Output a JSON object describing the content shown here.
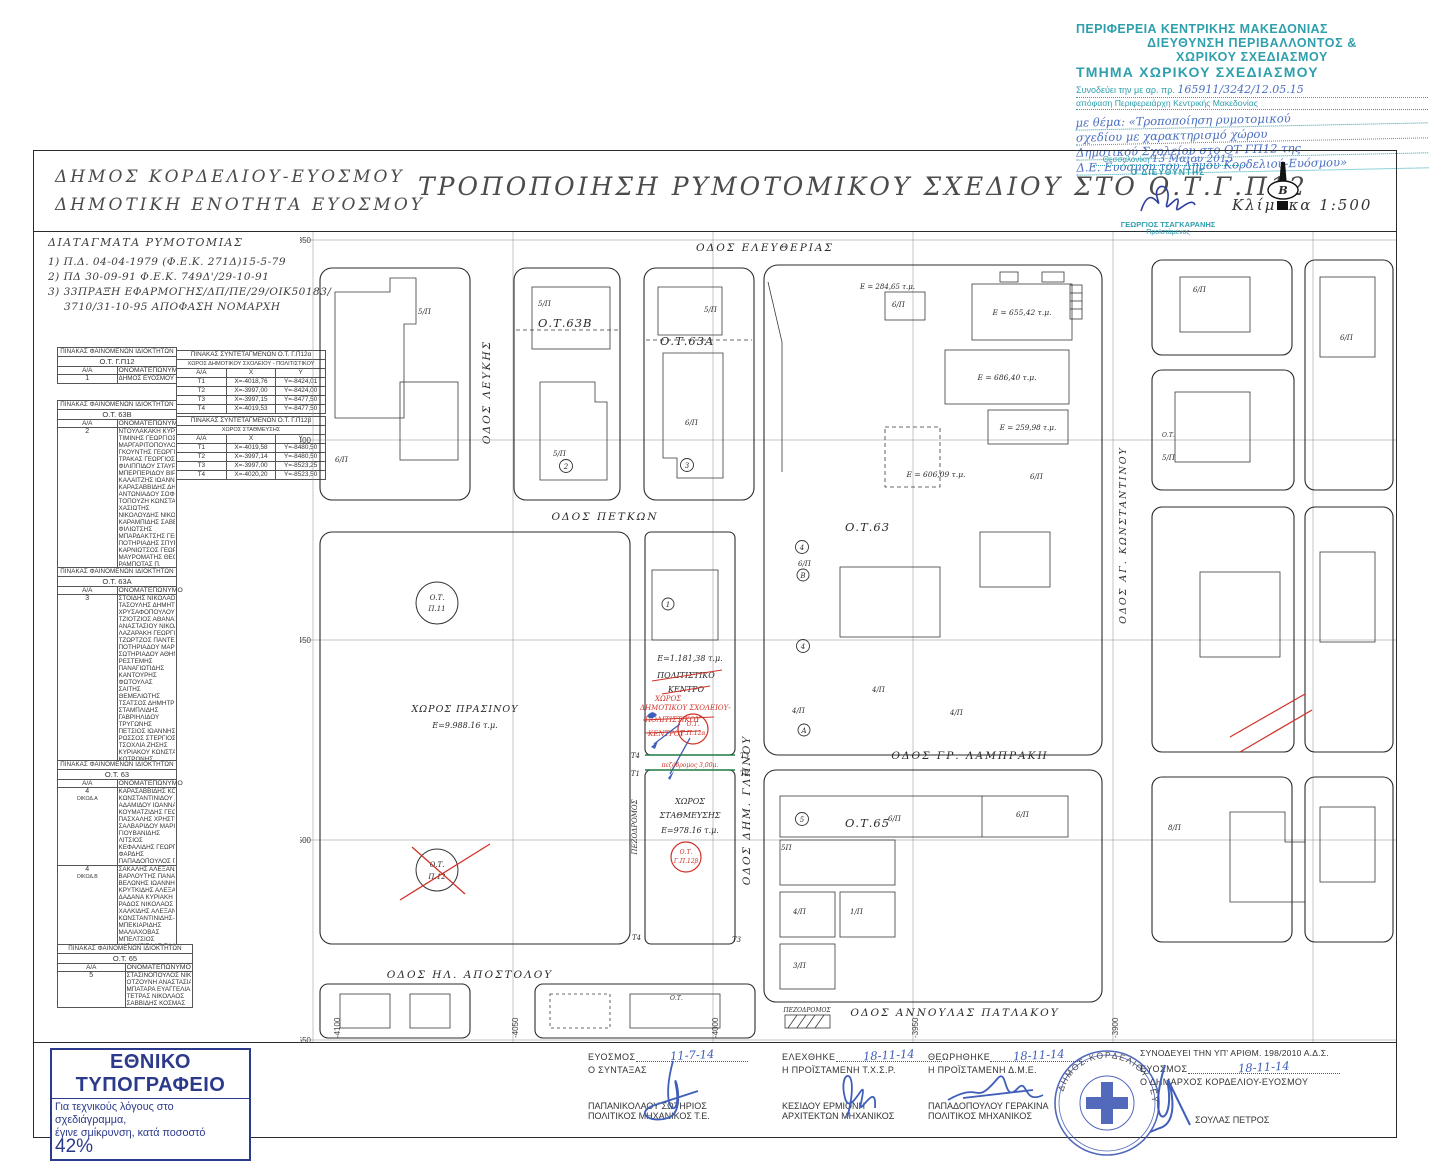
{
  "stamp_top": {
    "line1": "ΠΕΡΙΦΕΡΕΙΑ ΚΕΝΤΡΙΚΗΣ ΜΑΚΕΔΟΝΙΑΣ",
    "line2": "ΔΙΕΥΘΥΝΣΗ ΠΕΡΙΒΑΛΛΟΝΤΟΣ &",
    "line3": "ΧΩΡΙΚΟΥ ΣΧΕΔΙΑΣΜΟΥ",
    "line4": "ΤΜΗΜΑ ΧΩΡΙΚΟΥ ΣΧΕΔΙΑΣΜΟΥ",
    "ref_label": "Συνοδεύει την με αρ. πρ.",
    "ref_value": "165911/3242/12.05.15",
    "ref_line2": "απόφαση Περιφερειάρχη Κεντρικής Μακεδονίας",
    "handwritten": [
      "με θέμα: «Τροποποίηση ρυμοτομικού",
      "σχεδίου με χαρακτηρισμό χώρου",
      "Δημοτικού Σχολείου στο ΟΤ ΓΠ12 της",
      "Δ.Ε. Ευόσμου του Δήμου Κορδελιού-Ευόσμου»"
    ]
  },
  "title_block": {
    "muni1": "ΔΗΜΟΣ ΚΟΡΔΕΛΙΟΥ-ΕΥΟΣΜΟΥ",
    "muni2": "ΔΗΜΟΤΙΚΗ ΕΝΟΤΗΤΑ ΕΥΟΣΜΟΥ",
    "main_title": "ΤΡΟΠΟΠΟΙΗΣΗ ΡΥΜΟΤΟΜΙΚΟΥ ΣΧΕΔΙΟΥ ΣΤΟ Ο.Τ.Γ.Π12",
    "scale": "Κλίμακα 1:500",
    "north": "Β",
    "approval": {
      "place": "Θεσσαλονίκη",
      "date": "13 Μαΐου 2015",
      "role": "Ο ΔΙΕΥΘΥΝΤΗΣ",
      "name": "ΓΕΩΡΓΙΟΣ ΤΣΑΓΚΑΡΑΝΗΣ",
      "title": "Προϊστάμενος"
    }
  },
  "decrees": {
    "title": "ΔΙΑΤΑΓΜΑΤΑ ΡΥΜΟΤΟΜΙΑΣ",
    "items": [
      "1) Π.Δ. 04-04-1979 (Φ.Ε.Κ. 271Δ)15-5-79",
      "2) ΠΔ 30-09-91 Φ.Ε.Κ. 749Δ'/29-10-91",
      "3) 33ΠΡΑΞΗ ΕΦΑΡΜΟΓΗΣ/ΔΠ/ΠΕ/29/ΟΙΚ50183/",
      "3710/31-10-95 ΑΠΟΦΑΣΗ ΝΟΜΑΡΧΗ"
    ]
  },
  "tables": {
    "owners_title": "ΠΙΝΑΚΑΣ ΦΑΙΝΟΜΕΝΩΝ ΙΔΙΟΚΤΗΤΩΝ",
    "col_aa": "Α/Α",
    "col_name": "ΟΝΟΜΑΤΕΠΩΝΥΜΟ",
    "owners1": {
      "block": "Ο.Τ. Γ.Π12",
      "aa": "1",
      "names": [
        "ΔΗΜΟΣ ΕΥΟΣΜΟΥ"
      ]
    },
    "owners2": {
      "block": "Ο.Τ. 63Β",
      "aa": "2",
      "names": [
        "ΝΤΟΥΛΑΚΑΚΗ ΚΥΡΙΑΚΗ",
        "ΤΙΜΙΝΗΣ ΓΕΩΡΓΙΟΣ",
        "ΜΑΡΓΑΡΙΤΟΠΟΥΛΟΣ ΓΕΩΡΓΙΟΣ",
        "ΓΚΟΥΝΤΗΣ ΓΕΩΡΓΙΟΣ",
        "ΤΡΑΚΑΣ ΓΕΩΡΓΙΟΣ",
        "ΦΙΛΙΠΠΙΔΟΥ ΣΤΑΥΡΟΥΛΑ",
        "ΜΠΕΡΠΕΡΙΔΟΥ ΒΙΡΓΙΝΙΑ",
        "ΚΑΛΑΪΤΖΗΣ ΙΩΑΝΝΗΣ",
        "ΚΑΡΑΣΑΒΒΙΔΗΣ ΔΗΜΗΤΡΙΟΣ",
        "ΑΝΤΩΝΙΑΔΟΥ ΣΟΦΙΑ",
        "ΤΟΠΟΥΖΗ ΚΩΝΣΤΑΝΤΙΝΑ",
        "ΧΑΣΙΩΤΗΣ",
        "ΝΙΚΟΛΟΥΔΗΣ ΝΙΚΟΛΑΟΣ",
        "ΚΑΡΑΜΠΙΔΗΣ ΣΑΒΒΑΣ",
        "ΦΙΛΙΩΤΣΗΣ",
        "ΜΠΑΡΔΑΚΤΣΗΣ ΓΕΩΡΓΙΟΣ",
        "ΠΟΤΗΡΙΑΔΗΣ ΣΠΥΡΟΣ",
        "ΚΑΡΝΙΩΤΣΟΣ ΓΕΩΡΓΙΟΣ",
        "ΜΑΥΡΟΜΑΤΗΣ ΘΕΟΔΩΡΟΣ",
        "ΡΑΜΠΟΤΑΣ Π."
      ]
    },
    "owners3": {
      "block": "Ο.Τ. 63Α",
      "aa": "3",
      "names": [
        "ΣΤΟΪΔΗΣ ΝΙΚΟΛΑΟΣ",
        "ΤΑΣΟΥΛΗΣ ΔΗΜΗΤΡΙΟΣ",
        "ΧΡΥΣΑΦΟΠΟΥΛΟΥ ΕΛΕΝΗ",
        "ΤΖΙΟΤΖΙΟΣ ΑΘΑΝΑΣΙΟΣ",
        "ΑΝΑΣΤΑΣΙΟΥ ΝΙΚΟΛΑΟΣ",
        "ΛΑΖΑΡΑΚΗ ΓΕΩΡΓΙΑ",
        "ΤΖΩΡΤΖΟΣ ΠΑΝΤΕΛΗΣ",
        "ΠΟΤΗΡΙΑΔΟΥ ΜΑΡΙΑ",
        "ΣΩΤΗΡΙΑΔΟΥ ΑΘΗΝΑ",
        "ΡΕΣΤΕΜΗΣ",
        "ΠΑΝΑΓΙΩΤΙΔΗΣ",
        "ΚΑΝΤΟΥΡΗΣ",
        "ΦΩΤΟΥΛΑΣ",
        "ΣΑΪΤΗΣ",
        "ΘΕΜΕΛΙΩΤΗΣ",
        "ΤΣΑΤΣΟΣ ΔΗΜΗΤΡΙΟΣ",
        "ΣΤΑΜΠΛΙΔΗΣ",
        "ΓΑΒΡΙΗΛΙΔΟΥ",
        "ΤΡΥΓΩΝΗΣ",
        "ΠΕΤΣΙΟΣ ΙΩΑΝΝΗΣ",
        "ΡΩΣΣΟΣ ΣΤΕΡΓΙΟΣ",
        "ΤΣΟΧΛΙΑ ΖΗΣΗΣ",
        "ΚΥΡΙΑΚΟΥ ΚΩΝΣΤΑΝΤΙΝΟΣ",
        "ΚΟΤΡΩΝΗΣ"
      ]
    },
    "owners4": {
      "block": "Ο.Τ. 63",
      "groups": [
        {
          "aa": "4",
          "sub": "ΟΙΚΟΔ.Α",
          "names": [
            "ΚΑΡΑΣΑΒΒΙΔΗΣ ΚΟΣΜΑΣ",
            "ΚΩΝΣΤΑΝΤΙΝΙΔΟΥ ΧΡΥΣΑ",
            "ΑΔΑΜΙΔΟΥ ΙΩΑΝΝΑ",
            "ΚΟΥΜΑΤΖΙΔΗΣ ΓΕΩΡΓΙΟΣ",
            "ΠΑΣΧΑΛΗΣ ΧΡΗΣΤΟΣ",
            "ΣΑΛΒΑΡΙΔΟΥ ΜΑΡΙΑ",
            "ΓΙΟΥΒΑΝΙΔΗΣ",
            "ΛΙΤΣΙΟΣ",
            "ΚΕΦΑΛΙΔΗΣ ΓΕΩΡΓΙΟΣ",
            "ΦΑΡΔΗΣ",
            "ΠΑΠΑΔΟΠΟΥΛΟΣ ΠΕΡΙΚΛΗΣ"
          ]
        },
        {
          "aa": "4",
          "sub": "ΟΙΚΟΔ.Β",
          "names": [
            "ΣΑΚΑΛΗΣ ΑΛΕΞΑΝΔΡΟΣ",
            "ΒΑΡΛΟΥΤΗΣ ΠΑΝΑΓΙΩΤΗΣ",
            "ΒΕΛΩΝΗΣ ΙΩΑΝΝΗΣ",
            "ΚΡΥΤΚΙΔΗΣ ΑΛΕΞΑΝΔΡΟΣ",
            "ΔΑΔΑΝΑ ΚΥΡΙΑΚΗ",
            "ΡΑΔΟΣ ΝΙΚΟΛΑΟΣ",
            "ΧΑΛΚΙΔΗΣ ΑΛΕΞΑΝΔΡΟΣ",
            "ΚΩΝΣΤΑΝΤΙΝΙΔΗΣ-ΒΕΛΕΜΗ",
            "ΜΠΕΚΙΑΡΙΔΗΣ",
            "ΜΑΛΙΑΧΟΒΑΣ",
            "ΜΠΕΛΤΣΙΟΣ",
            "ΚΑΡΑΜΓΙΕΛΑΣ-ΣΑΛΒΑΡΙΔΟΥ(ΚΑΤ.)"
          ]
        }
      ]
    },
    "owners5": {
      "block": "Ο.Τ. 65",
      "aa": "5",
      "names": [
        "ΣΤΑΣΙΝΟΠΟΥΛΟΣ ΝΙΚΟΛΑΟΣ",
        "ΟΤΖΟΥΝΗ ΑΝΑΣΤΑΣΙΑ",
        "ΜΠΑΤΑΡΑ ΕΥΑΓΓΕΛΙΑ",
        "ΤΕΤΡΑΣ ΝΙΚΟΛΑΟΣ",
        "ΣΑΒΒΙΔΗΣ ΚΟΣΜΑΣ"
      ]
    },
    "coords1": {
      "title": "ΠΙΝΑΚΑΣ ΣΥΝΤΕΤΑΓΜΕΝΩΝ Ο.Τ. Γ.Π12α",
      "subtitle": "ΧΩΡΟΣ ΔΗΜΟΤΙΚΟΥ ΣΧΟΛΕΙΟΥ - ΠΟΛΙΤΙΣΤΙΚΟΥ",
      "headers": [
        "Α/Α",
        "Χ",
        "Υ"
      ],
      "rows": [
        [
          "Τ1",
          "Χ=-4018,76",
          "Υ=-8424,01"
        ],
        [
          "Τ2",
          "Χ=-3997,00",
          "Υ=-8424,00"
        ],
        [
          "Τ3",
          "Χ=-3997,15",
          "Υ=-8477,50"
        ],
        [
          "Τ4",
          "Χ=-4019,53",
          "Υ=-8477,50"
        ]
      ]
    },
    "coords2": {
      "title": "ΠΙΝΑΚΑΣ ΣΥΝΤΕΤΑΓΜΕΝΩΝ Ο.Τ. Γ.Π12β",
      "subtitle": "ΧΩΡΟΣ ΣΤΑΘΜΕΥΣΗΣ",
      "headers": [
        "Α/Α",
        "Χ",
        "Υ"
      ],
      "rows": [
        [
          "Τ1",
          "Χ=-4019,58",
          "Υ=-8480,50"
        ],
        [
          "Τ2",
          "Χ=-3997,14",
          "Υ=-8480,50"
        ],
        [
          "Τ3",
          "Χ=-3997,00",
          "Υ=-8523,25"
        ],
        [
          "Τ4",
          "Χ=-4020,20",
          "Υ=-8523,50"
        ]
      ]
    }
  },
  "map": {
    "grid_rows": [
      "-8350",
      "-8400",
      "-8450",
      "-8500",
      "-8550"
    ],
    "grid_cols": [
      "-4100",
      "-4050",
      "-4000",
      "-3950",
      "-3900"
    ],
    "streets": {
      "eleftherias": "ΟΔΟΣ ΕΛΕΥΘΕΡΙΑΣ",
      "lefkis": "ΟΔΟΣ ΛΕΥΚΗΣ",
      "petkon": "ΟΔΟΣ ΠΕΤΚΩΝ",
      "glinou": "ΟΔΟΣ ΔΗΜ. ΓΛΗΝΟΥ",
      "lambraki": "ΟΔΟΣ ΓΡ. ΛΑΜΠΡΑΚΗ",
      "ag_konstantinou": "ΟΔΟΣ ΑΓ. ΚΩΝΣΤΑΝΤΙΝΟΥ",
      "il_apostolou": "ΟΔΟΣ ΗΛ. ΑΠΟΣΤΟΛΟΥ",
      "annoulas_patlakou": "ΟΔΟΣ ΑΝΝΟΥΛΑΣ ΠΑΤΛΑΚΟΥ",
      "pezodromos": "ΠΕΖΟΔΡΟΜΟΣ"
    },
    "blocks": {
      "ot63b": "Ο.Τ.63Β",
      "ot63a": "Ο.Τ.63Α",
      "ot63": "Ο.Τ.63",
      "ot65": "Ο.Τ.65",
      "ot_small": "Ο.Τ."
    },
    "circles": {
      "ot": "Ο.Τ.",
      "p11": "Π.11",
      "p12": "Π.12",
      "gp12a": "Γ.Π.12α",
      "gp12b": "Γ.Π.12β"
    },
    "areas": {
      "green_l1": "ΧΩΡΟΣ ΠΡΑΣΙΝΟΥ",
      "green_l2": "Ε=9.988.16 τ.μ.",
      "school_area": "Ε=1.181,38 τ.μ.",
      "cultural_l1": "ΠΟΛΙΤΙΣΤΙΚΟ",
      "cultural_l2": "ΚΕΝΤΡΟ",
      "red_l1": "ΧΩΡΟΣ",
      "red_l2": "ΔΗΜΟΤΙΚΟΥ ΣΧΟΛΕΙΟΥ-",
      "red_l3": "ΠΟΛΙΤΙΣΤΙΚΟΥ",
      "red_l4": "ΚΕΝΤΡΟΥ",
      "pez_note": "πεζόδρομος 3,00μ.",
      "parking_l1": "ΧΩΡΟΣ",
      "parking_l2": "ΣΤΑΘΜΕΥΣΗΣ",
      "parking_area": "Ε=978.16 τ.μ.",
      "e1": "Ε = 284,65 τ.μ.",
      "e2": "Ε = 655,42 τ.μ.",
      "e3": "Ε = 686,40 τ.μ.",
      "e4": "Ε = 259,98 τ.μ.",
      "e5": "Ε = 606,09 τ.μ."
    },
    "plots": {
      "p5": "5/Π",
      "p6": "6/Π",
      "p4": "4/Π",
      "p1": "1/Π",
      "p3": "3/Π",
      "p5b": "5Π",
      "p8": "8/Π"
    },
    "badges": {
      "n1": "1",
      "n2": "2",
      "n3": "3",
      "n4": "4",
      "n5": "5",
      "a": "Α",
      "b": "Β"
    },
    "tpoints": {
      "t1": "Τ1",
      "t2": "Τ2",
      "t3": "Τ3",
      "t4": "Τ4"
    }
  },
  "footer": {
    "printing": {
      "title": "ΕΘΝΙΚΟ ΤΥΠΟΓΡΑΦΕΙΟ",
      "line1": "Για τεχνικούς λόγους στο σχεδιάγραμμα,",
      "line2": "έγινε σμίκρυνση, κατά ποσοστό",
      "pct": "42%"
    },
    "sig1": {
      "place": "ΕΥΟΣΜΟΣ",
      "date": "11-7-14",
      "role": "Ο ΣΥΝΤΑΞΑΣ",
      "name": "ΠΑΠΑΝΙΚΟΛΑΟΥ ΣΩΤΗΡΙΟΣ",
      "title": "ΠΟΛΙΤΙΚΟΣ ΜΗΧΑΝΙΚΟΣ Τ.Ε."
    },
    "sig2": {
      "place": "ΕΛΕΧΘΗΚΕ",
      "date": "18-11-14",
      "role": "Η ΠΡΟΪΣΤΑΜΕΝΗ Τ.Χ.Σ.Ρ.",
      "name": "ΚΕΣΙΔΟΥ ΕΡΜΙΟΝΗ",
      "title": "ΑΡΧΙΤΕΚΤΩΝ ΜΗΧΑΝΙΚΟΣ"
    },
    "sig3": {
      "place": "ΘΕΩΡΗΘΗΚΕ",
      "date": "18-11-14",
      "role": "Η ΠΡΟΪΣΤΑΜΕΝΗ Δ.Μ.Ε.",
      "name": "ΠΑΠΑΔΟΠΟΥΛΟΥ ΓΕΡΑΚΙΝΑ",
      "title": "ΠΟΛΙΤΙΚΟΣ ΜΗΧΑΝΙΚΟΣ"
    },
    "sig4": {
      "note": "ΣΥΝΟΔΕΥΕΙ ΤΗΝ ΥΠ' ΑΡΙΘΜ. 198/2010 Α.Δ.Σ.",
      "place": "ΕΥΟΣΜΟΣ",
      "date": "18-11-14",
      "role": "Ο ΔΗΜΑΡΧΟΣ ΚΟΡΔΕΛΙΟΥ-ΕΥΟΣΜΟΥ",
      "name": "ΣΟΥΛΑΣ ΠΕΤΡΟΣ"
    },
    "round_stamp": "ΔΗΜΟΣ ΚΟΡΔΕΛΙΟΥ - ΕΥΟΣΜΟΥ"
  }
}
